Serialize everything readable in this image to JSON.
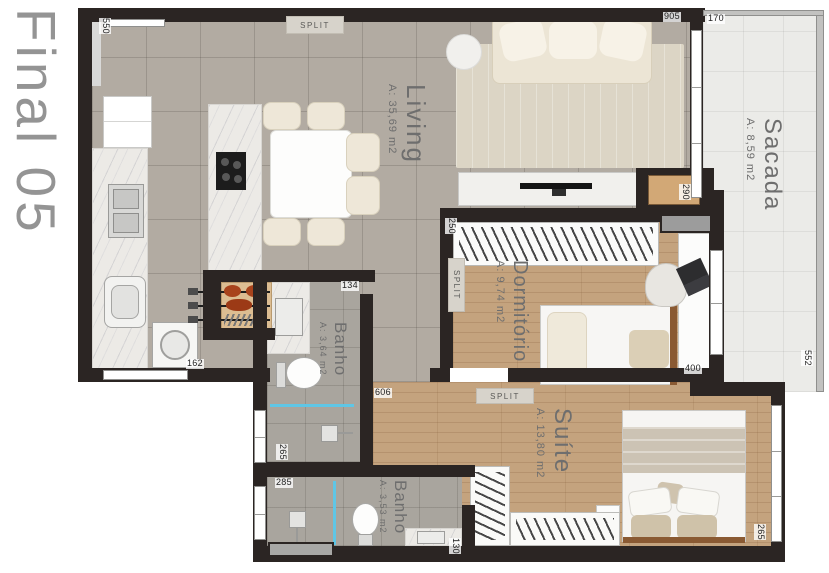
{
  "title": "Final 05",
  "rooms": {
    "living": {
      "name": "Living",
      "area": "A: 35,69 m2"
    },
    "sacada": {
      "name": "Sacada",
      "area": "A: 8,59 m2"
    },
    "dormitorio": {
      "name": "Dormitório",
      "area": "A: 9,74 m2"
    },
    "banho_social": {
      "name": "Banho",
      "area": "A: 3,64 m2"
    },
    "suite": {
      "name": "Suíte",
      "area": "A: 13,80 m2"
    },
    "banho_suite": {
      "name": "Banho",
      "area": "A: 3,53 m2"
    }
  },
  "hvac": {
    "split_label": "SPLIT"
  },
  "dimensions": {
    "top_window": "550",
    "living_top": "905",
    "sacada_top": "170",
    "living_sacada_opening": "290",
    "dorm_closet_wall": "250",
    "banho_social_door_wall": "134",
    "service_window": "162",
    "dorm_bottom_wall": "400",
    "sacada_rail": "552",
    "suite_entry": "606",
    "banho_social_window": "265",
    "banho_suite_window": "285",
    "banho_suite_counter": "130",
    "suite_window": "265"
  },
  "colors": {
    "wall": "#2b2523",
    "tile_floor": "#b2aba2",
    "wood_floor": "#c4a37e",
    "bath_floor": "#a9a59e",
    "balcony_floor": "#ebebe8",
    "marble": "#eceae6",
    "glass_partition": "#5fc6e6",
    "label_text": "#6e6e6e",
    "title_text": "#949494"
  }
}
